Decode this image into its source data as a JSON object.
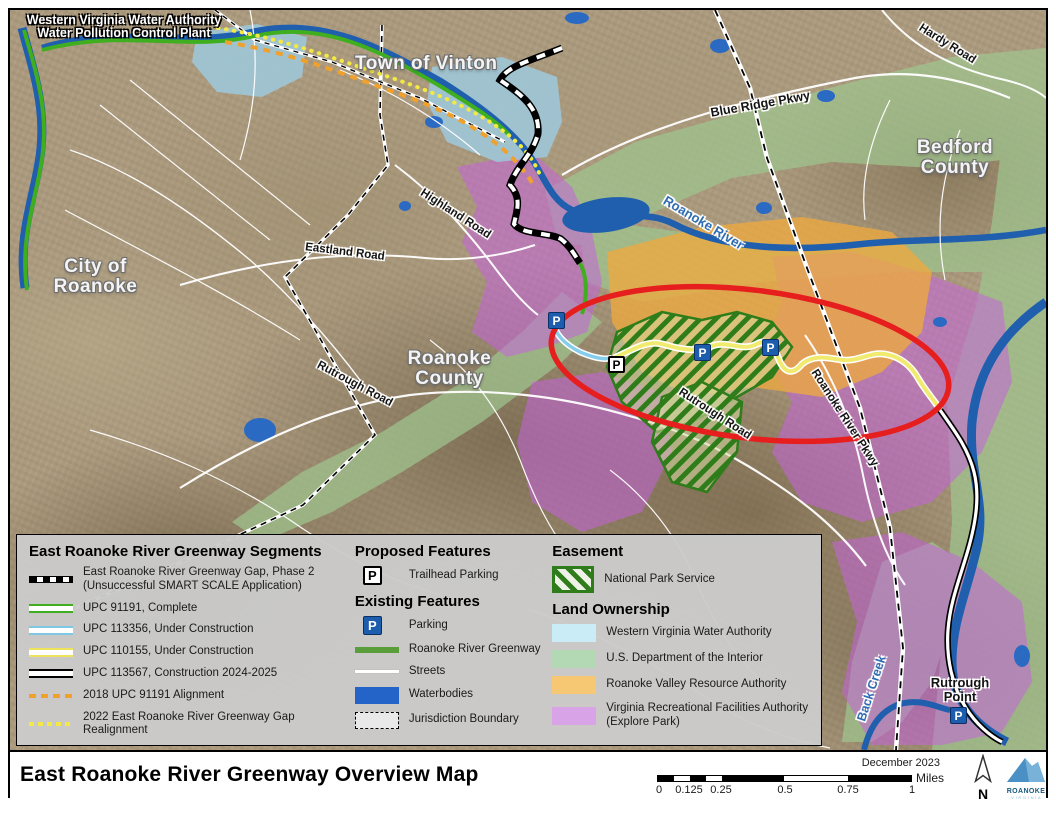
{
  "map_labels": {
    "plant_line1": "Western Virginia Water Authority",
    "plant_line2": "Water Pollution Control Plant",
    "town_of_vinton": "Town of Vinton",
    "hardy_road": "Hardy Road",
    "bedford_county_line1": "Bedford",
    "bedford_county_line2": "County",
    "blue_ridge_pkwy": "Blue Ridge Pkwy",
    "roanoke_river": "Roanoke River",
    "city_of_roanoke_line1": "City of",
    "city_of_roanoke_line2": "Roanoke",
    "eastland_road": "Eastland Road",
    "highland_road": "Highland Road",
    "roanoke_county_line1": "Roanoke",
    "roanoke_county_line2": "County",
    "rutrough_road_west": "Rutrough Road",
    "rutrough_road_center": "Rutrough Road",
    "roanoke_river_pkwy": "Roanoke River Pkwy",
    "back_creek": "Back Creek",
    "rutrough_point_line1": "Rutrough",
    "rutrough_point_line2": "Point",
    "parking_marker": "P"
  },
  "legend": {
    "segments": {
      "title": "East Roanoke River Greenway Segments",
      "items": [
        {
          "swatch": "gap-dashed-line",
          "label": "East Roanoke River Greenway Gap, Phase 2\n(Unsuccessful SMART SCALE Application)"
        },
        {
          "swatch": "green-double-line",
          "label": "UPC 91191, Complete"
        },
        {
          "swatch": "blue-double-line",
          "label": "UPC 113356, Under Construction"
        },
        {
          "swatch": "yellow-double-line",
          "label": "UPC 110155, Under Construction"
        },
        {
          "swatch": "black-cased-line",
          "label": "UPC 113567, Construction 2024-2025"
        },
        {
          "swatch": "orange-dashed-line",
          "label": "2018 UPC 91191 Alignment"
        },
        {
          "swatch": "yellow-dotted-line",
          "label": "2022 East Roanoke River Greenway Gap\nRealignment"
        }
      ]
    },
    "proposed": {
      "title": "Proposed Features",
      "items": [
        {
          "swatch": "white-parking-icon",
          "label": "Trailhead Parking"
        }
      ]
    },
    "existing": {
      "title": "Existing Features",
      "items": [
        {
          "swatch": "blue-parking-icon",
          "label": "Parking"
        },
        {
          "swatch": "green-line",
          "label": "Roanoke River Greenway"
        },
        {
          "swatch": "white-line",
          "label": "Streets"
        },
        {
          "swatch": "blue-fill",
          "label": "Waterbodies"
        },
        {
          "swatch": "dashed-outline",
          "label": "Jurisdiction Boundary"
        }
      ]
    },
    "easement": {
      "title": "Easement",
      "items": [
        {
          "swatch": "green-hatch",
          "label": "National Park Service"
        }
      ]
    },
    "land_ownership": {
      "title": "Land Ownership",
      "items": [
        {
          "color": "#c9ecf7",
          "label": "Western Virginia Water Authority"
        },
        {
          "color": "#b2d9b4",
          "label": "U.S. Department of the Interior"
        },
        {
          "color": "#f7c873",
          "label": "Roanoke Valley Resource Authority"
        },
        {
          "color": "#d9a3e8",
          "label": "Virginia Recreational Facilities Authority\n(Explore Park)"
        }
      ]
    }
  },
  "footer": {
    "title": "East Roanoke River Greenway Overview Map",
    "date": "December 2023",
    "scale_ticks": [
      "0",
      "0.125",
      "0.25",
      "0.5",
      "0.75",
      "1"
    ],
    "scale_unit": "Miles",
    "north_label": "N",
    "logo_text": "ROANOKE",
    "logo_subtext": "V I R G I N I A"
  },
  "colors": {
    "highlight_ellipse_red": "#e61e1e",
    "greenway_complete_green": "#3fae1f",
    "under_construction_blue": "#86cdec",
    "under_construction_yellow": "#eee45c",
    "alignment_2018_orange": "#f0a02c",
    "realignment_2022_yellow": "#f2ea43",
    "nps_easement_green": "#2e7d1a",
    "wvwa_fill": "#c9ecf7",
    "usdoi_fill": "#b2d9b4",
    "rvra_fill": "#f7c873",
    "vrfa_fill": "#d9a3e8",
    "waterbody_blue": "#2a6ac3",
    "parking_blue": "#1c5dae"
  }
}
